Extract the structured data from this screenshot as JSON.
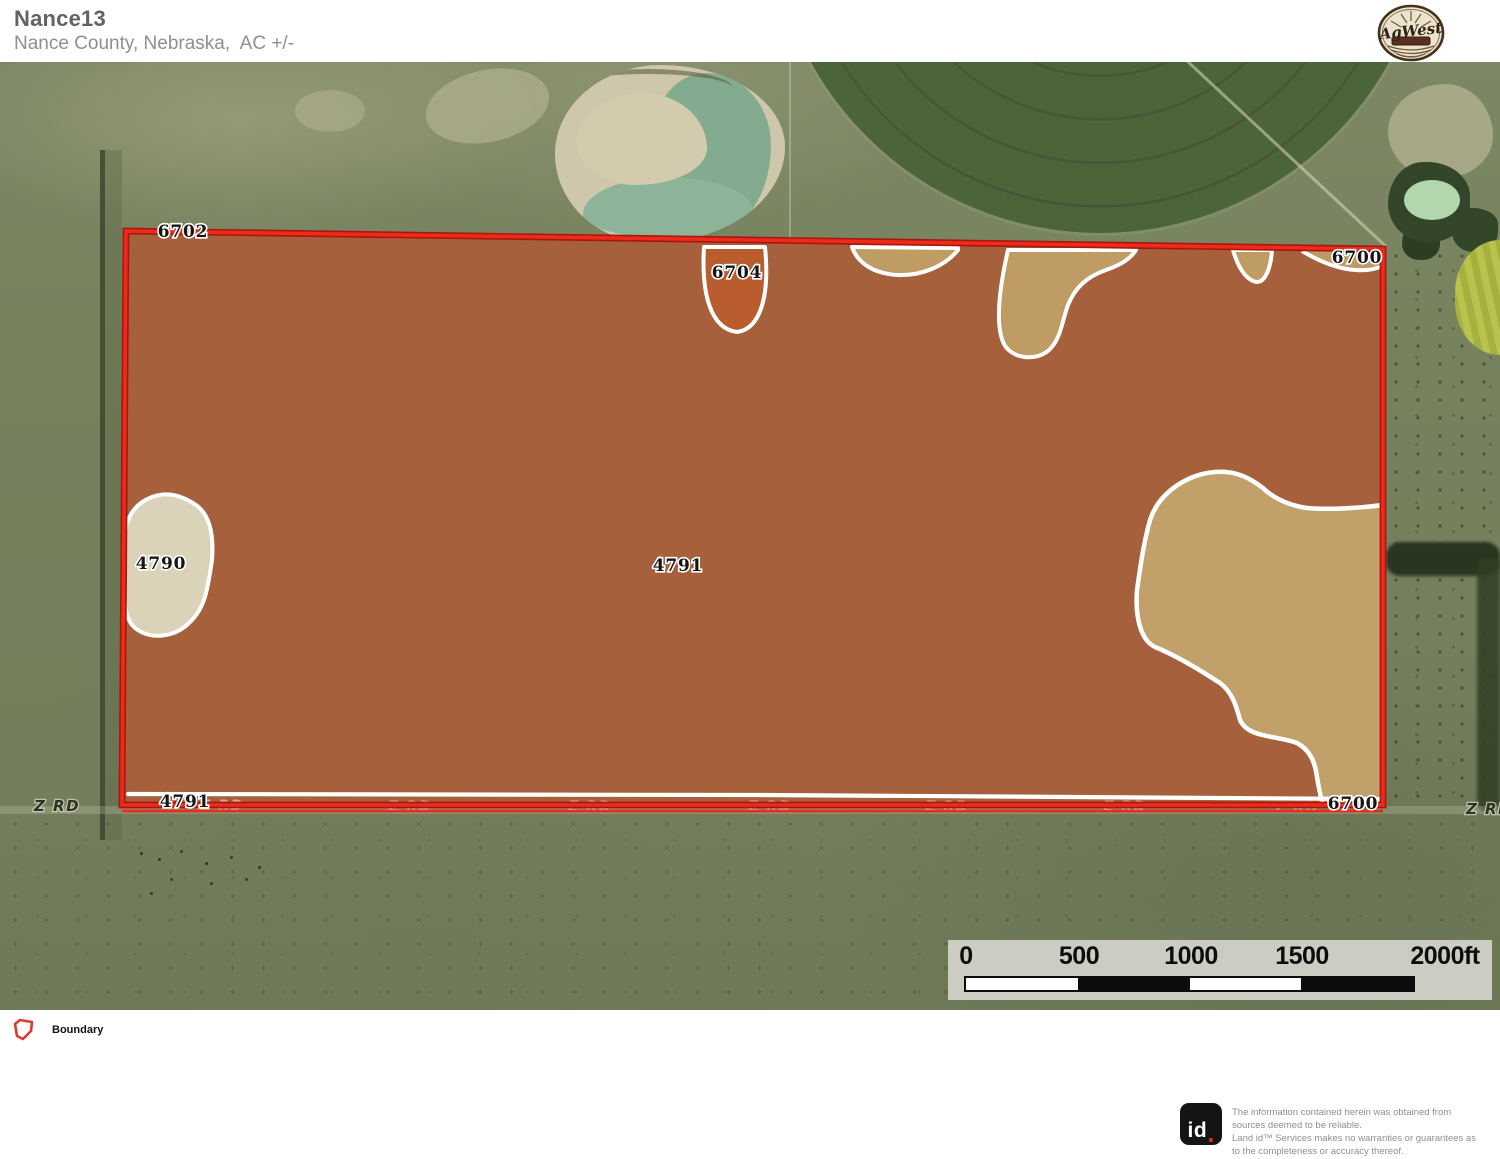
{
  "header": {
    "title": "Nance13",
    "subtitle": "Nance County, Nebraska,  AC +/-"
  },
  "branding": {
    "agwest_logo_text": "AgWest"
  },
  "map": {
    "soil_labels": [
      {
        "text": "6702"
      },
      {
        "text": "6704"
      },
      {
        "text": "6700"
      },
      {
        "text": "4790"
      },
      {
        "text": "4791"
      },
      {
        "text": "4791"
      },
      {
        "text": "6700"
      }
    ],
    "road_label": "Z RD"
  },
  "scale_bar": {
    "ticks": [
      "0",
      "500",
      "1000",
      "1500",
      "2000ft"
    ]
  },
  "legend": {
    "boundary_label": "Boundary"
  },
  "footer": {
    "logo_id": "id",
    "logo_dot": ".",
    "disclaimer": "The information contained herein was obtained from sources deemed to be reliable.\nLand id™ Services makes no warranties or guarantees as to the completeness or accuracy thereof."
  },
  "colors": {
    "boundary_red": "#ee2a1a",
    "soil_main_brown": "#a6613c",
    "soil_orange": "#b95c2e",
    "soil_tan": "#c1a169",
    "soil_cream": "#dbd2ba",
    "soil_outline_white": "#ffffff"
  }
}
